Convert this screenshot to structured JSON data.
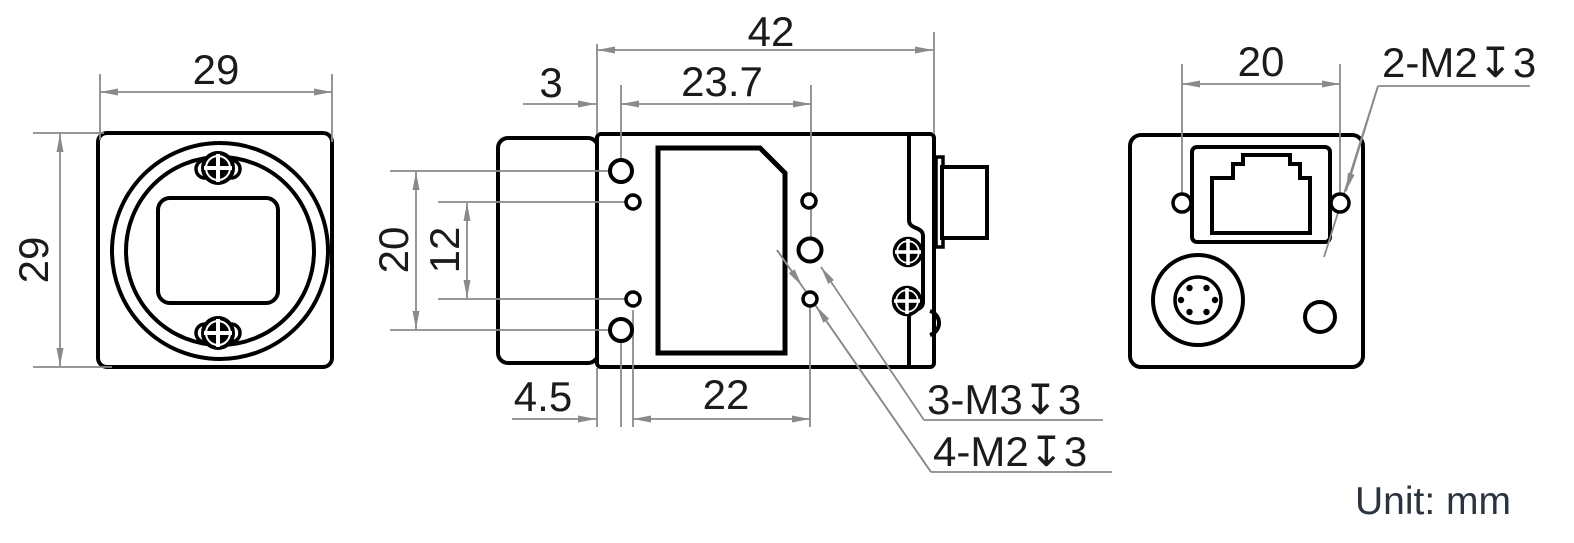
{
  "unit_note": "Unit: mm",
  "colors": {
    "outline_black": "#000000",
    "dimension_gray": "#8a8a8a",
    "unit_text": "#2b333e"
  },
  "front_view": {
    "width_mm": "29",
    "height_mm": "29"
  },
  "side_view": {
    "total_width_mm": "42",
    "edge_to_m3_hole_mm": "3",
    "m3_hole_span_mm": "23.7",
    "m3_vertical_span_mm": "20",
    "m2_vertical_span_mm": "12",
    "edge_to_m2_hole_mm": "4.5",
    "m2_hole_span_mm": "22",
    "m3_thread_label": "3-M3↧3",
    "m2_thread_label": "4-M2↧3"
  },
  "back_view": {
    "hole_span_mm": "20",
    "thread_label": "2-M2↧3"
  }
}
